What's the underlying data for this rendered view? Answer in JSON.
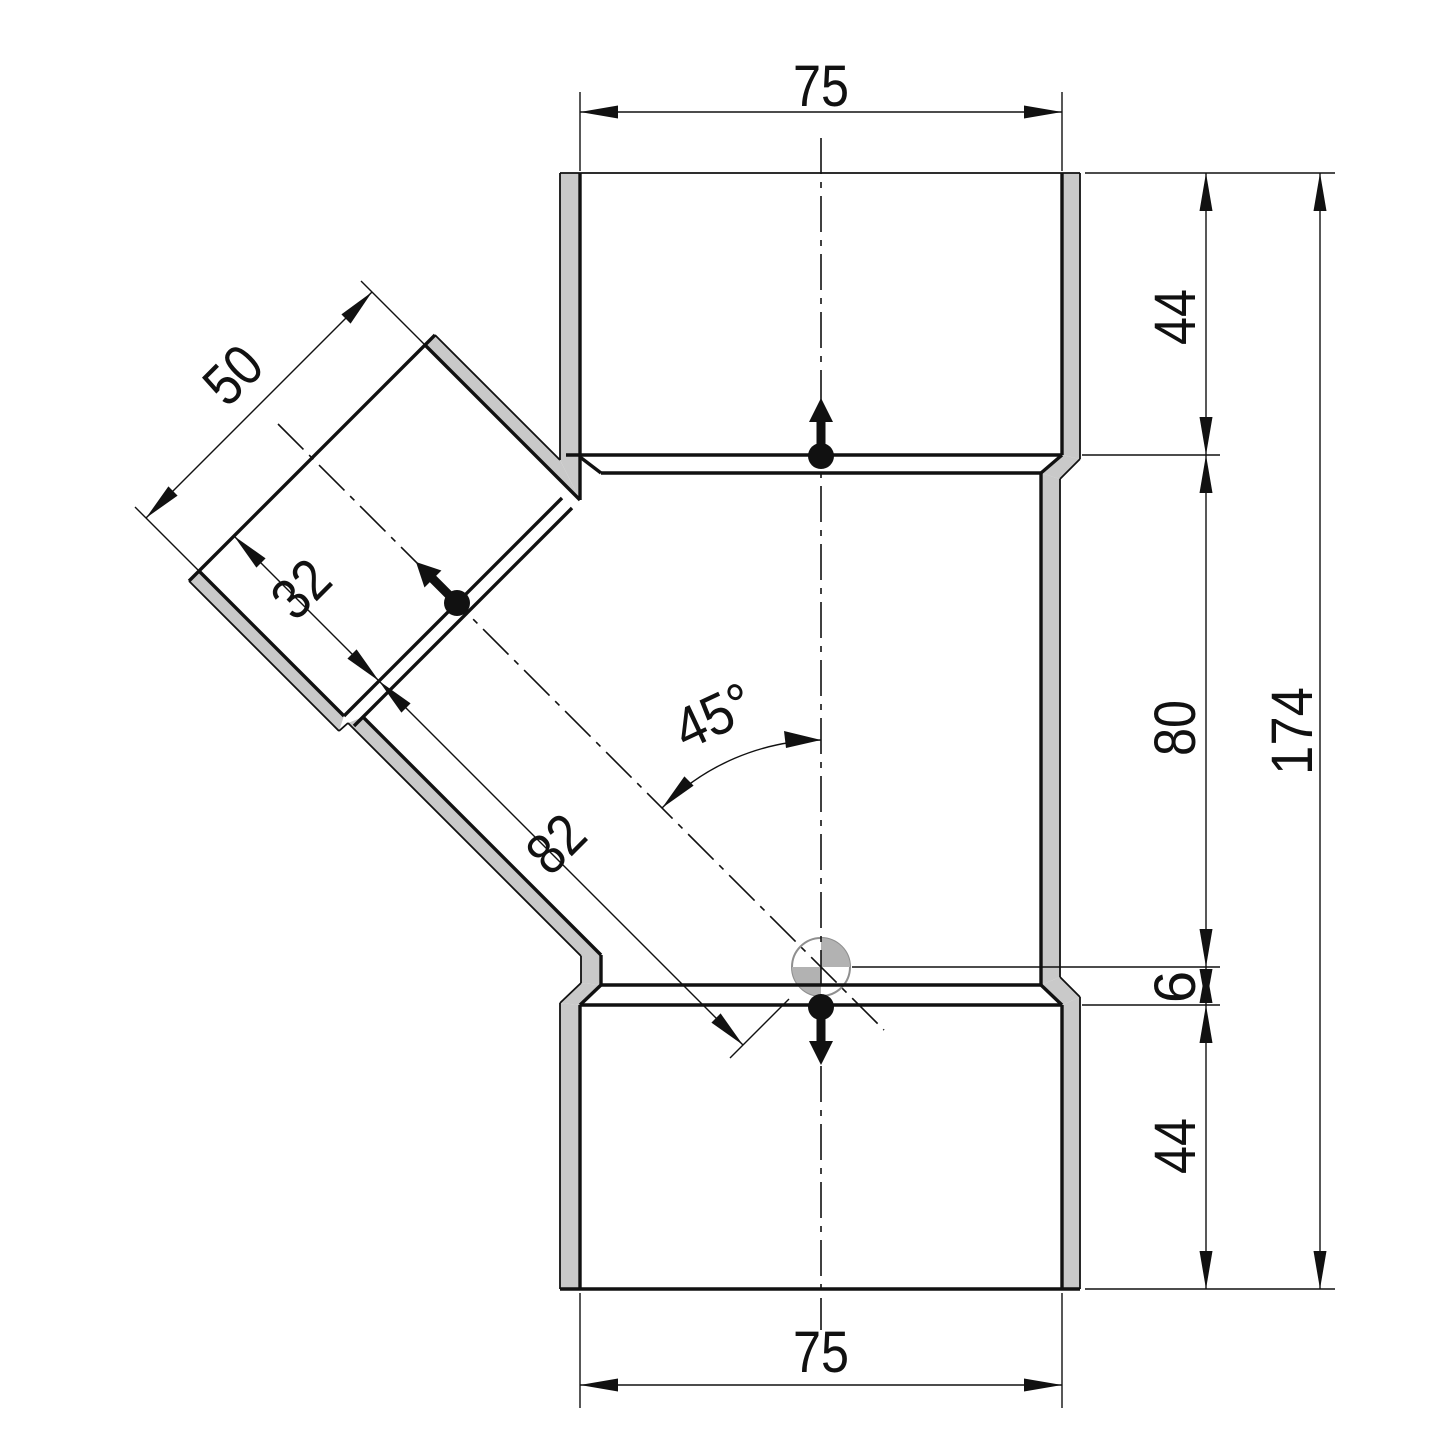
{
  "drawing": {
    "dimensions": {
      "top_width": "75",
      "bottom_width": "75",
      "top_socket_depth": "44",
      "shoulder_to_center": "80",
      "center_to_bottom_shoulder": "6",
      "bottom_socket_depth": "44",
      "overall_height": "174",
      "branch_width": "50",
      "branch_socket_depth": "32",
      "branch_shoulder_to_center": "82",
      "branch_angle": "45°"
    },
    "colors": {
      "line": "#111111",
      "wall_fill": "#c9c9c9",
      "centroid_fill": "#b2b2b2",
      "background": "#ffffff"
    }
  }
}
